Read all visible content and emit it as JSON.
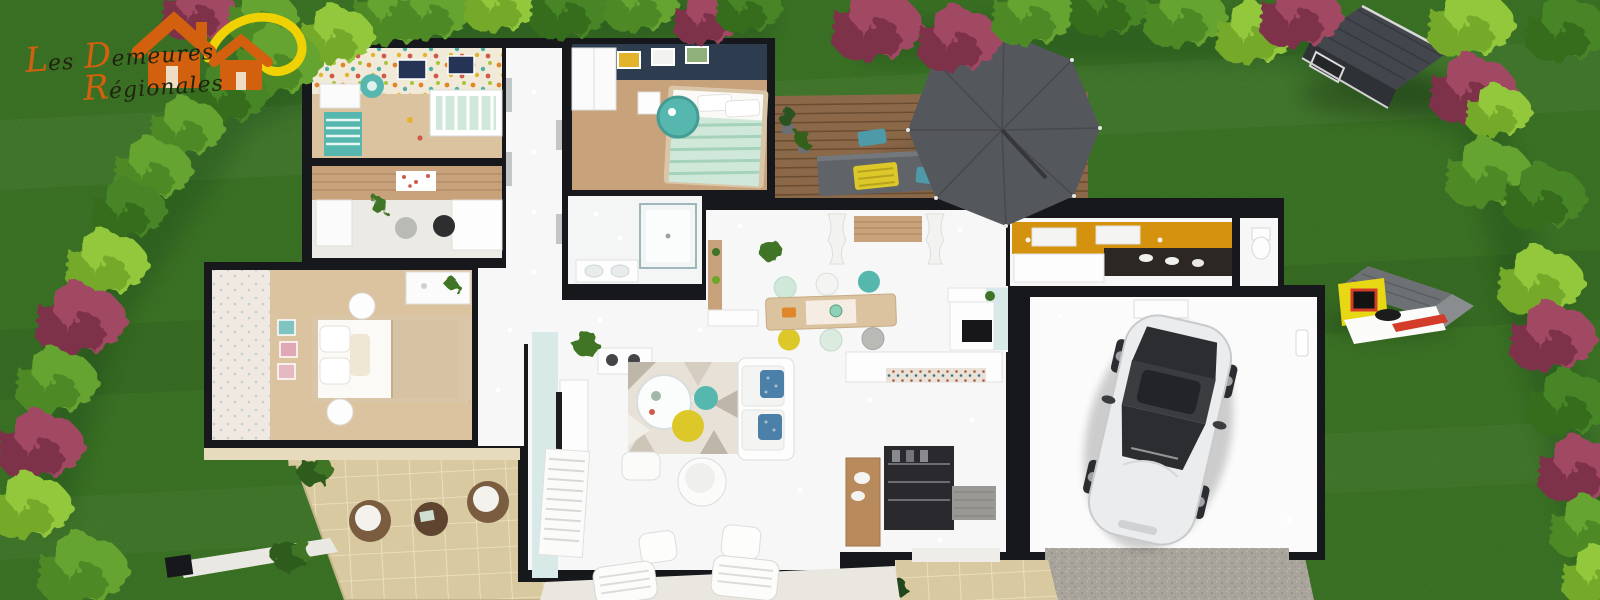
{
  "logo": {
    "word1_initial": "L",
    "word1_rest": "es",
    "word2_initial": "D",
    "word2_rest": "emeures",
    "word3_initial": "R",
    "word3_rest": "égionales"
  },
  "palette": {
    "grass": "#3e7827",
    "grass_shade": "#2c5a1b",
    "wall": "#17181c",
    "floor": "#f6f7f6",
    "wood": "#c7a27b",
    "wood_light": "#dcc3a0",
    "deck": "#8a6848",
    "deck_line": "#6a4c31",
    "navy": "#2e3c4f",
    "kitchen_orange": "#d4920e",
    "teal": "#55b7ae",
    "mint": "#cfe8da",
    "mint_stripe": "#a6d2bc",
    "pale_blue": "#d8eae8",
    "yellow": "#ddc829",
    "patio": "#d8c9a0",
    "patio_line": "#efe4c3",
    "gravel": "#a8a39b",
    "stone_path": "#dccea3",
    "parasol": "#54575b",
    "parasol_line": "#46494d",
    "car_body": "#ebecee",
    "car_glass": "#2c2d31",
    "shed_roof": "#43474d",
    "shed_side": "#2e3136",
    "bush_bright": "#93c83e",
    "bush_bright_lo": "#74a92c",
    "bush_mid": "#66a433",
    "bush_mid_lo": "#4d8a26",
    "bush_dark": "#478527",
    "bush_dark_lo": "#346d1c",
    "bush_mag": "#a14a63",
    "bush_mag_lo": "#7e3049",
    "logo_orange": "#d2600e",
    "logo_sun": "#f0d103",
    "logo_text": "#20230e",
    "cream": "#e6dcbd",
    "blue_pillow": "#4b80a8",
    "rug_base": "#e7e1d7",
    "rug_tri": "#beb6a9",
    "wicker": "#7a5c40",
    "chair_blue": "#4f9aa8",
    "closet_dark": "#2a2a2e",
    "counter_dark": "#2d2723"
  },
  "scene": {
    "objects": [
      "lawn",
      "hedge-border",
      "builder-logo",
      "house-floorplan",
      "nursery-room",
      "office-room",
      "master-bedroom",
      "navy-bedroom",
      "bathroom",
      "hallway",
      "dining-room",
      "kitchen",
      "wc",
      "entrance-hall",
      "living-room",
      "garage",
      "white-car",
      "wood-deck-terrace",
      "cantilever-parasol",
      "outdoor-table",
      "garden-shed",
      "kids-playhouse",
      "stone-patio",
      "wicker-lounge-chairs",
      "stone-path",
      "gravel-driveway"
    ]
  }
}
